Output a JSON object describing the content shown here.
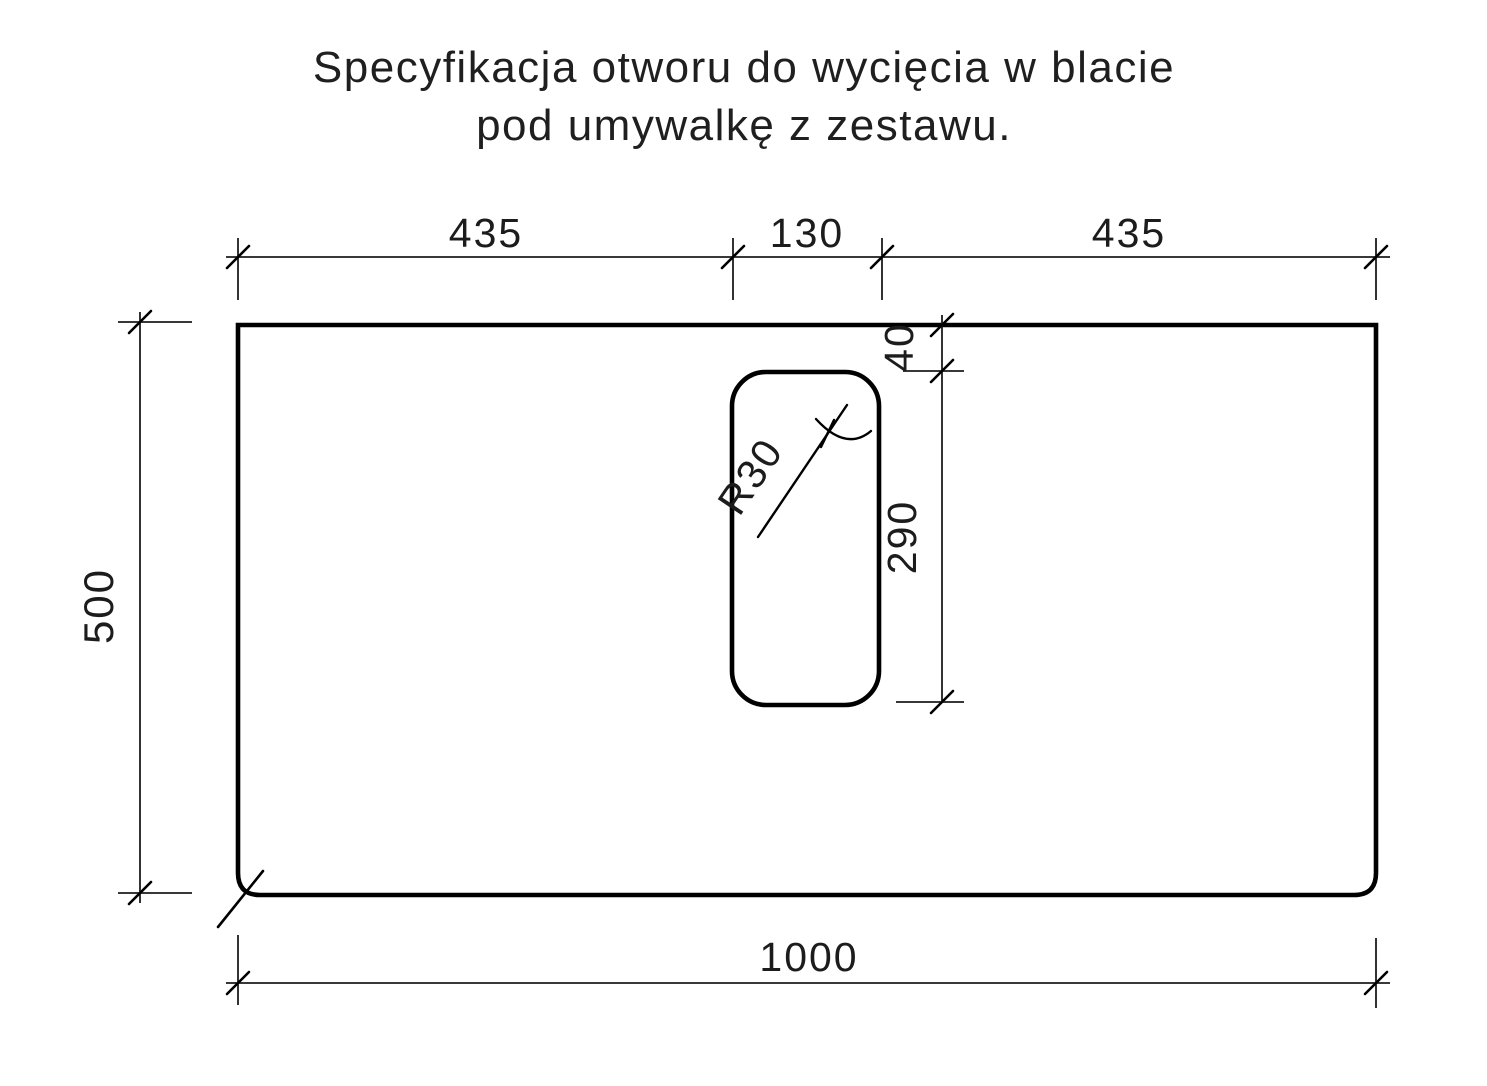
{
  "title": {
    "line1": "Specyfikacja otworu do wycięcia w blacie",
    "line2": "pod umywalkę z zestawu."
  },
  "dimensions": {
    "top_left_segment": "435",
    "top_middle_segment": "130",
    "top_right_segment": "435",
    "cutout_offset_from_top": "40",
    "cutout_height": "290",
    "board_height": "500",
    "board_width": "1000",
    "corner_radius_label": "R30"
  },
  "colors": {
    "line": "#000000",
    "text": "#1c1c1c",
    "background": "#ffffff"
  }
}
